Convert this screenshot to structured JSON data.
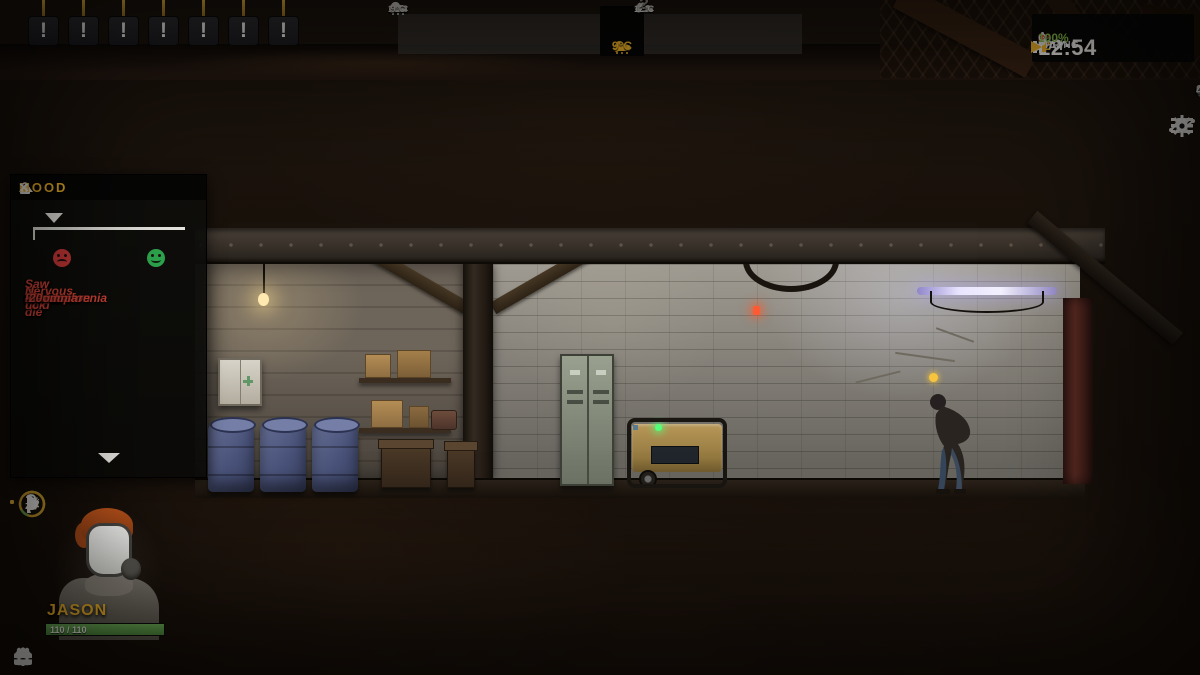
{
  "alerts": {
    "symbol": "!",
    "count": 7
  },
  "weather": {
    "cells": [
      {
        "temp": "17°C",
        "icon": "cloud",
        "state": "past-faded"
      },
      {
        "temp": "14°C",
        "icon": "cloud",
        "state": "past-faded"
      },
      {
        "temp": "16°C",
        "icon": "rain-cloud",
        "state": "past"
      },
      {
        "temp": "16°C",
        "icon": "cloud",
        "state": "past"
      },
      {
        "temp": "19°C",
        "icon": "rain-cloud",
        "state": "past"
      },
      {
        "temp": "9°C",
        "icon": "cloud",
        "state": "past"
      },
      {
        "temp": "9°C",
        "icon": "rain-cloud-yellow",
        "state": "current"
      },
      {
        "temp": "12°C",
        "icon": "cloud",
        "state": "forecast"
      },
      {
        "temp": "?",
        "icon": "unknown",
        "state": "forecast"
      },
      {
        "temp": "?",
        "icon": "unknown",
        "state": "forecast"
      },
      {
        "temp": "?",
        "icon": "unknown",
        "state": "forecast"
      },
      {
        "temp": "?",
        "icon": "unknown",
        "state": "forecast"
      }
    ]
  },
  "clock": {
    "day_label": "DAY",
    "day_value": "2",
    "season": "SPRING",
    "time": "12:54",
    "temperature": "8°",
    "oxygen_label": "O₂",
    "oxygen_value": "100%"
  },
  "resources": [
    {
      "name": "water",
      "value": "89"
    },
    {
      "name": "food",
      "value": "69"
    },
    {
      "name": "fuel",
      "value": "4"
    }
  ],
  "menu": {
    "help_glyph": "?"
  },
  "mood_panel": {
    "title": "MOOD",
    "close_glyph": "×",
    "entries": [
      {
        "label": "Saw friend die",
        "value": "-75"
      },
      {
        "label": "Saw friend die",
        "value": "-75"
      },
      {
        "label": "Is cold",
        "value": "-20"
      },
      {
        "label": "Depression",
        "value": "-20"
      },
      {
        "label": "Nervous tick",
        "value": "-20"
      },
      {
        "label": "Shock",
        "value": "-20"
      },
      {
        "label": "Schizophrenia",
        "value": "-20"
      },
      {
        "label": "Insomnia",
        "value": "-20"
      }
    ]
  },
  "character_panel": {
    "name": "JASON",
    "health": "110 / 110"
  },
  "colors": {
    "accent_yellow": "#f0b429",
    "negative_red": "#d8463a",
    "health_green": "#5a9e4a",
    "oxygen_green": "#8bc34a",
    "temp_red": "#e23b2e"
  }
}
